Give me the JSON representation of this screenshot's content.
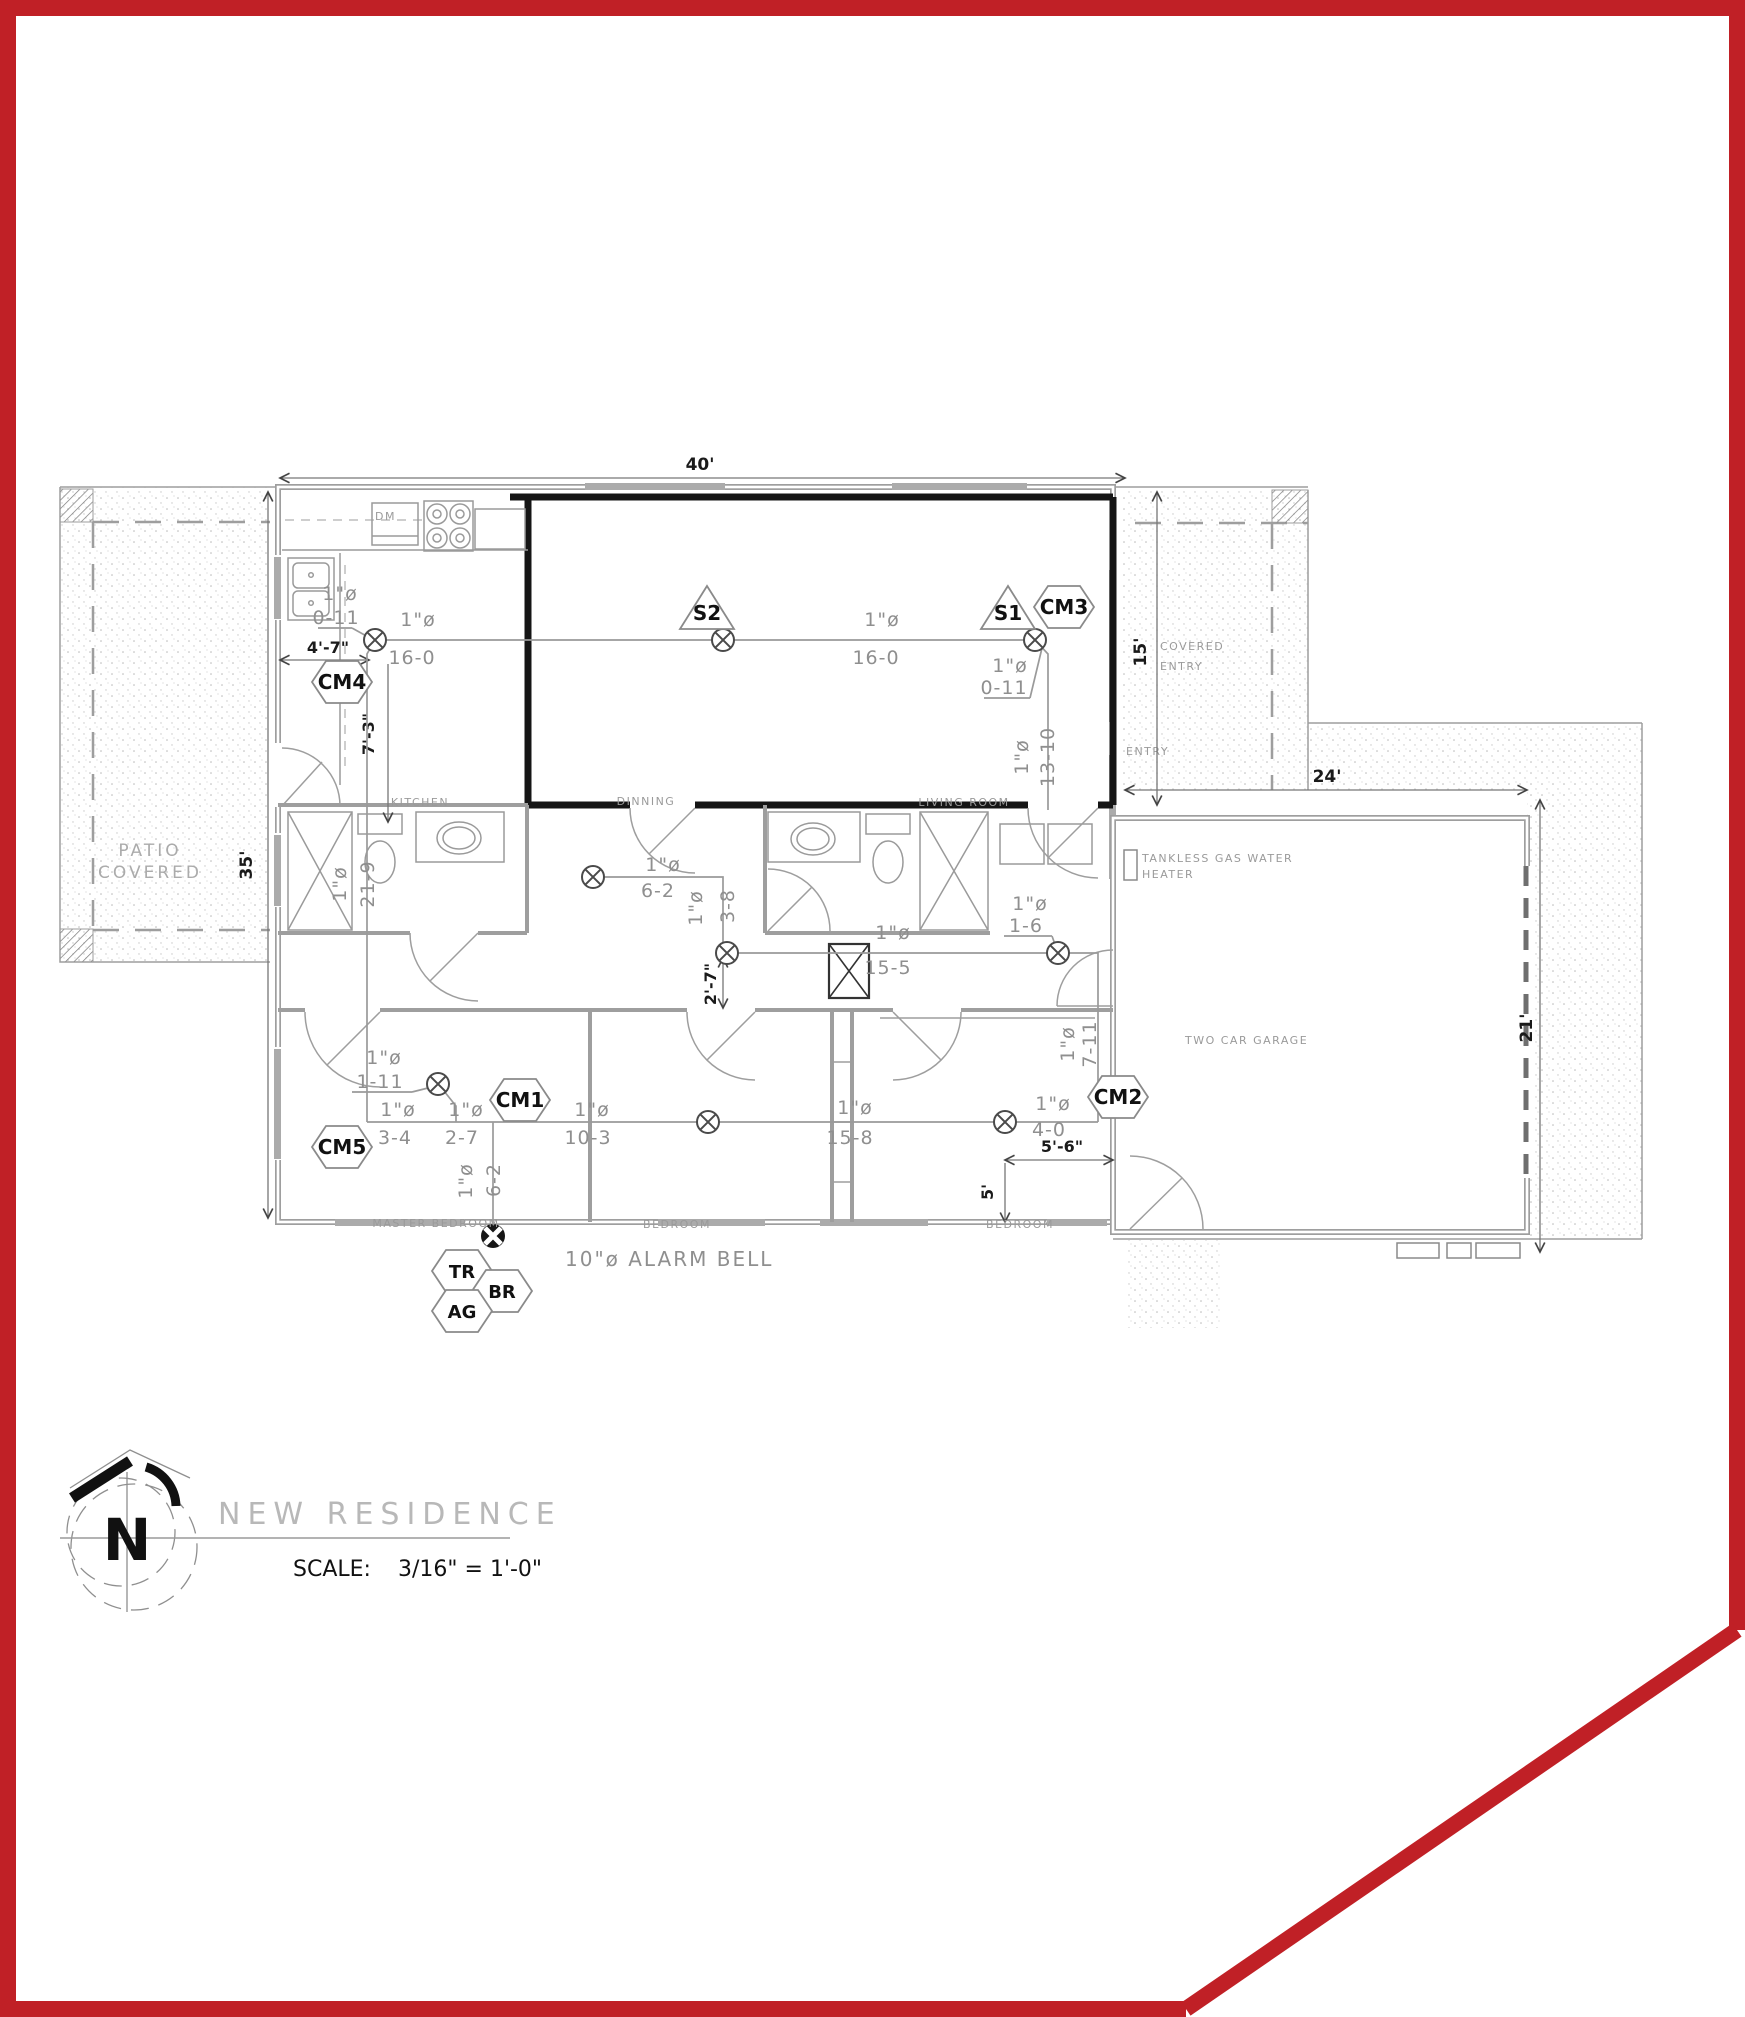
{
  "drawing": {
    "title": "NEW RESIDENCE",
    "scale_label": "SCALE:",
    "scale_value": "3/16\" = 1'-0\"",
    "north_letter": "N"
  },
  "rooms": {
    "kitchen": "KITCHEN",
    "dining": "DINNING",
    "living": "LIVING ROOM",
    "master_bedroom": "MASTER BEDROOM",
    "bedroom_mid": "BEDROOM",
    "bedroom_right": "BEDROOM",
    "garage": "TWO CAR GARAGE",
    "patio_line1": "PATIO",
    "patio_line2": "COVERED",
    "covered_entry_line1": "COVERED",
    "covered_entry_line2": "ENTRY",
    "entry": "ENTRY",
    "water_heater_line1": "TANKLESS GAS WATER",
    "water_heater_line2": "HEATER",
    "dishwasher": "DM"
  },
  "dimensions": {
    "overall_width": "40'",
    "overall_height": "35'",
    "entry_height": "15'",
    "garage_width": "24'",
    "garage_height": "21'",
    "kitchen_offset": "4'-7\"",
    "kitchen_drop": "7'-3\"",
    "hall_offset": "2'-7\"",
    "bed_offset_w": "5'-6\"",
    "bed_offset_h": "5'"
  },
  "conduits": {
    "dia": "1\"ø",
    "len_0_11_a": "0-11",
    "len_16_0_a": "16-0",
    "len_16_0_b": "16-0",
    "len_0_11_b": "0-11",
    "len_13_10": "13-10",
    "len_21_9": "21-9",
    "len_6_2_hall": "6-2",
    "len_3_8": "3-8",
    "len_15_5": "15-5",
    "len_1_6": "1-6",
    "len_1_11": "1-11",
    "len_3_4": "3-4",
    "len_2_7": "2-7",
    "len_10_3": "10-3",
    "len_15_8": "15-8",
    "len_4_0": "4-0",
    "len_7_11": "7-11",
    "len_6_2_bell": "6-2"
  },
  "tags": {
    "s1": "S1",
    "s2": "S2",
    "cm1": "CM1",
    "cm2": "CM2",
    "cm3": "CM3",
    "cm4": "CM4",
    "cm5": "CM5",
    "tr": "TR",
    "br": "BR",
    "ag": "AG"
  },
  "alarm_bell_label": "10\"ø ALARM BELL",
  "colors": {
    "frame": "#c02026",
    "line_gray": "#9a9a9a",
    "text_gray": "#8f8f8f",
    "black": "#1a1a1a"
  }
}
